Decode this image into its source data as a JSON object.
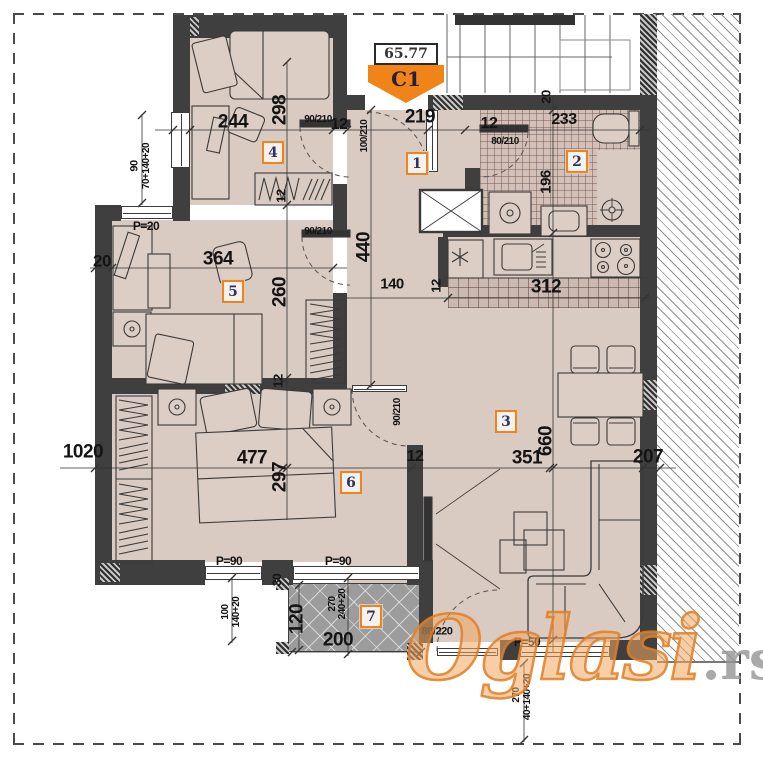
{
  "tag": {
    "area_value": "65.77",
    "unit_code": "C1"
  },
  "watermark": {
    "brand": "Oglasi",
    "tld": ".rs"
  },
  "colors": {
    "accent_orange": "#ee8420",
    "wall": "#3f3f3f",
    "floor": "#d9cac2",
    "terrace_gray": "#9c9c9c",
    "watermark_orange": "#e07e26",
    "watermark_gray": "#949494"
  },
  "room_badges": [
    {
      "n": "1",
      "x": 417,
      "y": 164
    },
    {
      "n": "2",
      "x": 577,
      "y": 162
    },
    {
      "n": "3",
      "x": 506,
      "y": 422
    },
    {
      "n": "4",
      "x": 273,
      "y": 153
    },
    {
      "n": "5",
      "x": 233,
      "y": 292
    },
    {
      "n": "6",
      "x": 351,
      "y": 483
    },
    {
      "n": "7",
      "x": 371,
      "y": 617
    }
  ],
  "labels": [
    {
      "t": "244",
      "x": 233,
      "y": 122,
      "s": 19
    },
    {
      "t": "298",
      "x": 280,
      "y": 110,
      "s": 19,
      "r": -90
    },
    {
      "t": "12",
      "x": 339,
      "y": 125,
      "s": 16
    },
    {
      "t": "219",
      "x": 420,
      "y": 117,
      "s": 19
    },
    {
      "t": "12",
      "x": 489,
      "y": 124,
      "s": 16
    },
    {
      "t": "233",
      "x": 564,
      "y": 120,
      "s": 16
    },
    {
      "t": "20",
      "x": 546,
      "y": 97,
      "s": 13,
      "r": -90
    },
    {
      "t": "90/210",
      "x": 318,
      "y": 120,
      "s": 10
    },
    {
      "t": "100/210",
      "x": 365,
      "y": 136,
      "s": 10,
      "r": -90
    },
    {
      "t": "80/210",
      "x": 505,
      "y": 142,
      "s": 10
    },
    {
      "t": "196",
      "x": 546,
      "y": 182,
      "s": 15,
      "r": -90
    },
    {
      "t": "90",
      "x": 135,
      "y": 166,
      "s": 11,
      "r": -90
    },
    {
      "t": "70+140+20",
      "x": 147,
      "y": 166,
      "s": 10,
      "r": -90
    },
    {
      "t": "P=20",
      "x": 146,
      "y": 226,
      "s": 12
    },
    {
      "t": "20",
      "x": 102,
      "y": 261,
      "s": 17
    },
    {
      "t": "364",
      "x": 218,
      "y": 259,
      "s": 19
    },
    {
      "t": "12",
      "x": 281,
      "y": 196,
      "s": 13,
      "r": -90
    },
    {
      "t": "90/210",
      "x": 318,
      "y": 232,
      "s": 10
    },
    {
      "t": "260",
      "x": 280,
      "y": 292,
      "s": 19,
      "r": -90
    },
    {
      "t": "440",
      "x": 364,
      "y": 247,
      "s": 19,
      "r": -90
    },
    {
      "t": "140",
      "x": 392,
      "y": 284,
      "s": 15
    },
    {
      "t": "12",
      "x": 436,
      "y": 286,
      "s": 13,
      "r": -90
    },
    {
      "t": "312",
      "x": 546,
      "y": 287,
      "s": 19
    },
    {
      "t": "1020",
      "x": 83,
      "y": 452,
      "s": 19
    },
    {
      "t": "477",
      "x": 252,
      "y": 458,
      "s": 19
    },
    {
      "t": "297",
      "x": 280,
      "y": 477,
      "s": 19,
      "r": -90
    },
    {
      "t": "12",
      "x": 278,
      "y": 381,
      "s": 13,
      "r": -90
    },
    {
      "t": "12",
      "x": 415,
      "y": 457,
      "s": 16
    },
    {
      "t": "351",
      "x": 527,
      "y": 458,
      "s": 19
    },
    {
      "t": "660",
      "x": 546,
      "y": 441,
      "s": 19,
      "r": -90
    },
    {
      "t": "207",
      "x": 648,
      "y": 457,
      "s": 19
    },
    {
      "t": "90/210",
      "x": 398,
      "y": 412,
      "s": 10,
      "r": -90
    },
    {
      "t": "P=90",
      "x": 229,
      "y": 561,
      "s": 12
    },
    {
      "t": "P=90",
      "x": 338,
      "y": 561,
      "s": 12
    },
    {
      "t": "100",
      "x": 226,
      "y": 612,
      "s": 10,
      "r": -90
    },
    {
      "t": "140+20",
      "x": 237,
      "y": 612,
      "s": 10,
      "r": -90
    },
    {
      "t": "30",
      "x": 277,
      "y": 580,
      "s": 12,
      "r": -90
    },
    {
      "t": "120",
      "x": 297,
      "y": 619,
      "s": 19,
      "r": -90
    },
    {
      "t": "200",
      "x": 338,
      "y": 640,
      "s": 19
    },
    {
      "t": "270",
      "x": 333,
      "y": 604,
      "s": 10,
      "r": -90
    },
    {
      "t": "240+20",
      "x": 343,
      "y": 604,
      "s": 10,
      "r": -90
    },
    {
      "t": "80/220",
      "x": 437,
      "y": 632,
      "s": 11
    },
    {
      "t": "P=50",
      "x": 527,
      "y": 642,
      "s": 12
    },
    {
      "t": "270",
      "x": 517,
      "y": 695,
      "s": 10,
      "r": -90
    },
    {
      "t": "40+140+20",
      "x": 528,
      "y": 697,
      "s": 10,
      "r": -90
    }
  ]
}
